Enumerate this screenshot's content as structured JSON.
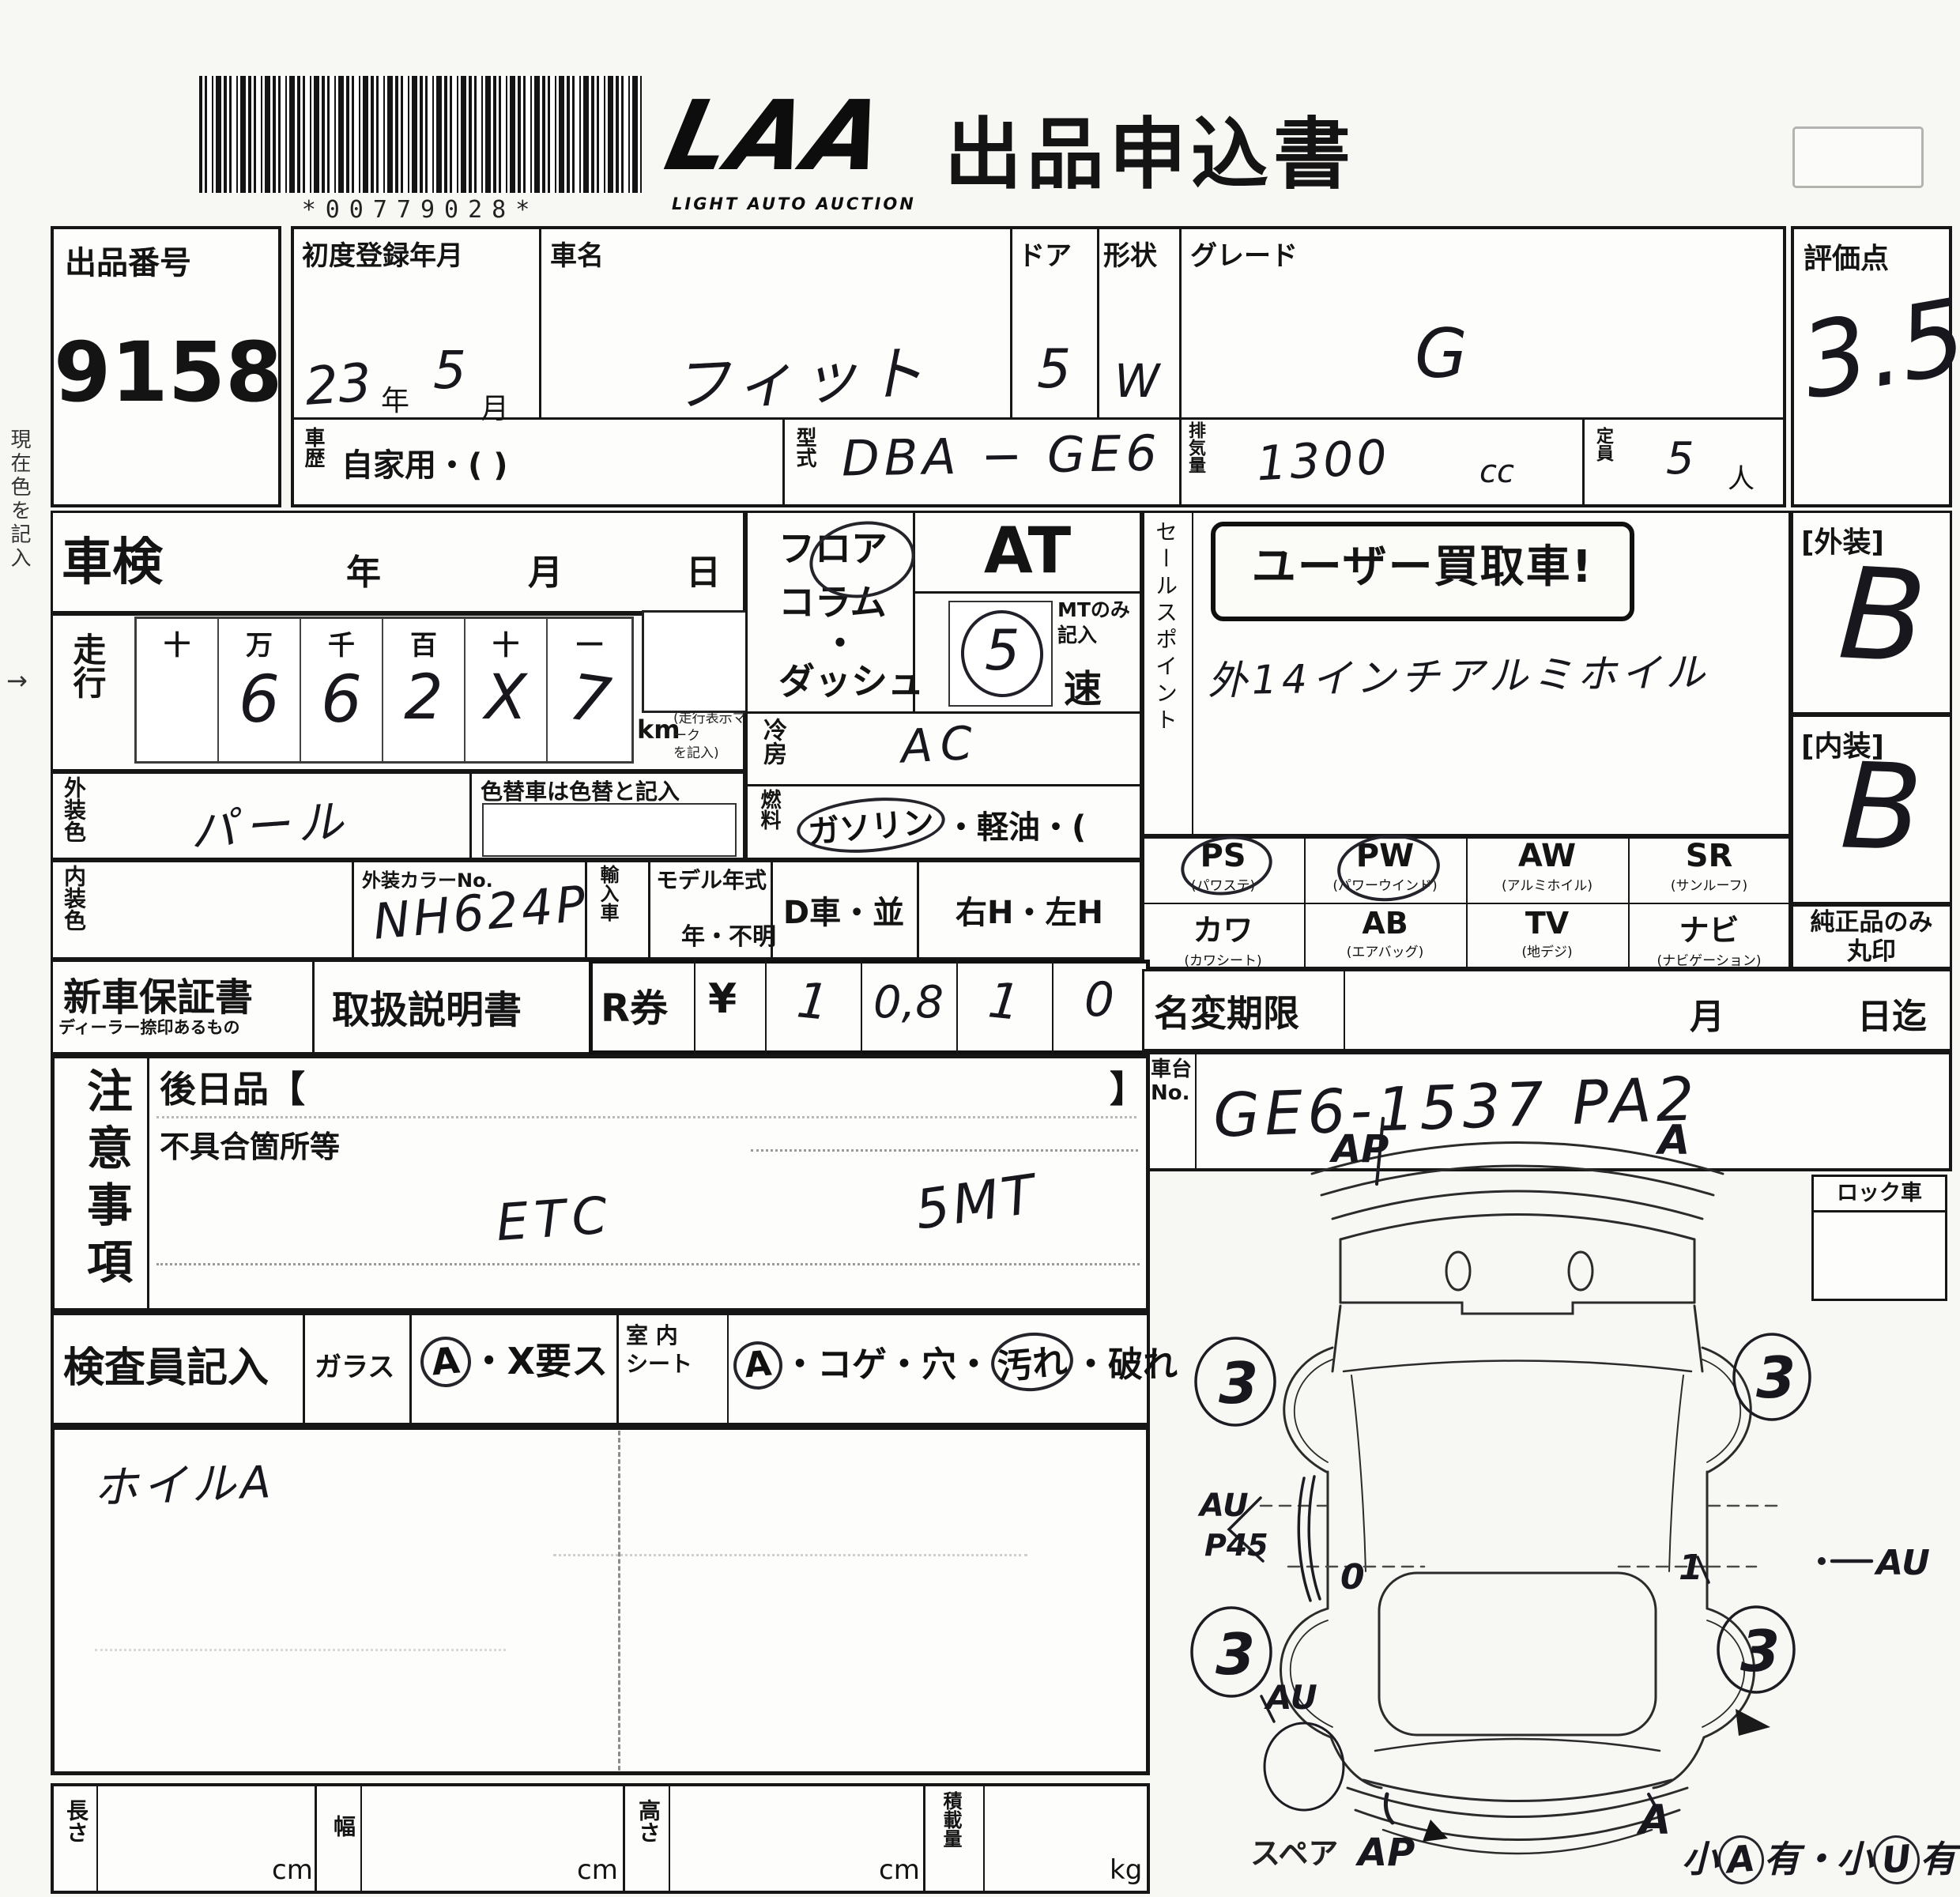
{
  "header": {
    "barcode_text": "*00779028*",
    "logo_main": "LAA",
    "logo_sub": "LIGHT AUTO AUCTION",
    "title": "出品申込書"
  },
  "lot_no": {
    "label": "出品番号",
    "value": "9158"
  },
  "evaluation": {
    "label": "評価点",
    "value": "3.5"
  },
  "top": {
    "first_reg_label": "初度登録年月",
    "first_reg_year": "23",
    "year_unit": "年",
    "first_reg_month": "5",
    "month_unit": "月",
    "car_name_label": "車名",
    "car_name": "フィット",
    "door_label": "ドア",
    "door": "5",
    "shape_label": "形状",
    "shape": "W",
    "grade_label": "グレード",
    "grade": "G",
    "history_label": "車歴",
    "history_value": "自家用・(                )",
    "model_label": "型式",
    "model_value": "DBA − GE6",
    "disp_label": "排気量",
    "disp_value": "1300",
    "disp_unit": "cc",
    "capacity_label": "定員",
    "capacity_value": "5",
    "capacity_unit": "人"
  },
  "shaken": {
    "label": "車検",
    "year_unit": "年",
    "month_unit": "月",
    "day_unit": "日"
  },
  "mileage": {
    "label": "走行",
    "headers": [
      "十",
      "万",
      "千",
      "百",
      "十",
      "一"
    ],
    "digits": [
      "",
      "6",
      "6",
      "2",
      "X",
      "7"
    ],
    "unit": "km",
    "note": "(走行表示マーク\nを記入)"
  },
  "colors": {
    "ext_label": "外装色",
    "ext_value": "パール",
    "change_note": "色替車は色替と記入",
    "int_label": "内装色",
    "color_no_label": "外装カラーNo.",
    "color_no_value": "NH624P",
    "import_label": "輸入車",
    "model_year_label": "モデル年式",
    "model_year_value": "年・不明",
    "d_car": "D車・並",
    "handle": "右H・左H"
  },
  "trans": {
    "pos1": "フロア",
    "pos2": "コラム",
    "pos3": "・",
    "pos4": "ダッシュ",
    "at": "AT",
    "mt_note": "MTのみ\n記入",
    "mt_value": "5",
    "speed_unit": "速"
  },
  "aircon": {
    "label": "冷房",
    "value": "AC"
  },
  "fuel": {
    "label": "燃料",
    "circled": "ガソリン",
    "rest": "・軽油・(",
    "close": ")"
  },
  "sales": {
    "label": "セールスポイント",
    "stamp": "ユーザー買取車!",
    "note": "外14インチアルミホイル"
  },
  "equip": {
    "r1c1": "PS",
    "r1c1s": "(パワステ)",
    "r1c2": "PW",
    "r1c2s": "(パワーウインド)",
    "r1c3": "AW",
    "r1c3s": "(アルミホイル)",
    "r1c4": "SR",
    "r1c4s": "(サンルーフ)",
    "r2c1": "カワ",
    "r2c1s": "(カワシート)",
    "r2c2": "AB",
    "r2c2s": "(エアバッグ)",
    "r2c3": "TV",
    "r2c3s": "(地デジ)",
    "r2c4": "ナビ",
    "r2c4s": "(ナビゲーション)",
    "genuine": "純正品のみ\n丸印"
  },
  "ratings": {
    "ext_label": "[外装]",
    "ext": "B",
    "int_label": "[内装]",
    "int": "B"
  },
  "docs": {
    "warranty": "新車保証書",
    "warranty_sub": "ディーラー捺印あるもの",
    "manual": "取扱説明書",
    "r_label": "R券",
    "yen": "¥",
    "v1": "1",
    "v2": "0,8",
    "v3": "1",
    "v4": "0"
  },
  "name_change": {
    "label": "名変期限",
    "month": "月",
    "until": "日迄"
  },
  "chassis": {
    "label": "車台\nNo.",
    "value": "GE6-1537 PA2"
  },
  "lock": {
    "label": "ロック車"
  },
  "notes": {
    "label": "注意事項",
    "later": "後日品【",
    "later_close": "】",
    "defect": "不具合箇所等",
    "hand1": "ETC",
    "hand2": "5MT"
  },
  "inspector": {
    "label": "検査員記入",
    "glass": "ガラス",
    "glass_c": "A",
    "glass_rest": "・X要ス",
    "seat_label": "室 内\nシート",
    "seat_c1": "A",
    "seat_m": "・コゲ・穴・",
    "seat_c2": "汚れ",
    "seat_e": "・破れ",
    "hand": "ホイルA"
  },
  "dims": {
    "length": "長さ",
    "width": "幅",
    "height": "高さ",
    "load": "積載量",
    "cm": "cm",
    "kg": "kg"
  },
  "margin": {
    "note": "現在色を記入",
    "arrow": "→"
  },
  "diagram": {
    "front_left": "AP",
    "front_right": "A",
    "wheel": "3",
    "left1": "AU",
    "left2": "P45",
    "right": "AU",
    "rear_left": "AU",
    "spare": "スペア",
    "rear_ap": "AP",
    "rear_a": "A",
    "mark0": "0",
    "mark1": "1",
    "sn1": "小",
    "snc1": "A",
    "sn2": "有・小",
    "snc2": "U",
    "sn3": "有"
  }
}
